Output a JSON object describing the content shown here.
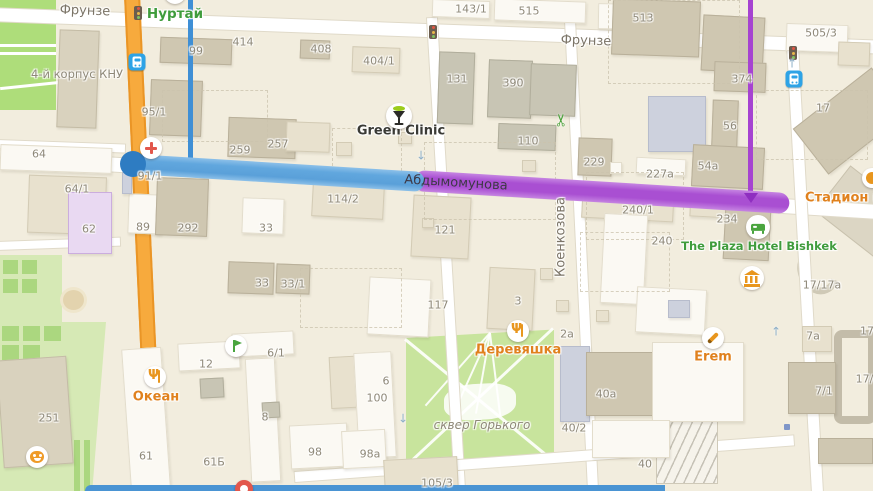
{
  "map_title": "Bishkek map — route highlighted on Abdymomunova street",
  "colors": {
    "background": "#f2edde",
    "major_road_orange": "#f7aa3d",
    "route_blue": "#61a7de",
    "route_blue_dark": "#2e7cc2",
    "route_purple": "#a94fd2",
    "poi_orange": "#e0811d",
    "poi_green": "#3f9c3c",
    "label_gray": "#8e8878",
    "park_green": "#c8e49d"
  },
  "route": {
    "street": "Абдымомунова",
    "segments": [
      {
        "color": "blue",
        "from_x": 133,
        "to_x": 424
      },
      {
        "color": "purple",
        "from_x": 414,
        "to_x": 790
      }
    ],
    "has_start_marker": true,
    "has_direction_arrow": true
  },
  "street_labels": [
    {
      "label": "Фрунзе",
      "x": 85,
      "y": 11,
      "rot": 2,
      "cls": "street"
    },
    {
      "label": "Фрунзе",
      "x": 586,
      "y": 41,
      "rot": 2,
      "cls": "street"
    },
    {
      "label": "Абдымомунова",
      "x": 456,
      "y": 183,
      "rot": 3.5,
      "cls": "onroute"
    },
    {
      "label": "Коенкозова",
      "x": 561,
      "y": 237,
      "rot": -90,
      "cls": "street"
    }
  ],
  "area_labels": [
    {
      "label": "4-й корпус КНУ",
      "x": 77,
      "y": 74,
      "size": 11.5,
      "italic": false
    },
    {
      "label": "сквер Горького",
      "x": 482,
      "y": 425,
      "size": 12,
      "italic": true
    }
  ],
  "poi_labels": [
    {
      "label": "Нуртай",
      "cls": "poi-green",
      "x": 175,
      "y": 14,
      "size": 13.5
    },
    {
      "label": "Green Clinic",
      "cls": "poi-dark",
      "x": 401,
      "y": 131,
      "size": 13
    },
    {
      "label": "Океан",
      "cls": "poi-orange",
      "x": 156,
      "y": 397,
      "size": 13
    },
    {
      "label": "Деревяшка",
      "cls": "poi-orange",
      "x": 518,
      "y": 350,
      "size": 13
    },
    {
      "label": "Erem",
      "cls": "poi-orange",
      "x": 713,
      "y": 357,
      "size": 13
    },
    {
      "label": "The Plaza Hotel Bishkek",
      "cls": "poi-green",
      "x": 759,
      "y": 246,
      "size": 11.5
    },
    {
      "label": "Стадион им. До",
      "cls": "poi-orange",
      "x": 805,
      "y": 198,
      "size": 13,
      "anchor": "left"
    }
  ],
  "building_numbers": [
    {
      "t": "99",
      "x": 196,
      "y": 51
    },
    {
      "t": "414",
      "x": 243,
      "y": 42
    },
    {
      "t": "408",
      "x": 321,
      "y": 49
    },
    {
      "t": "404/1",
      "x": 379,
      "y": 61
    },
    {
      "t": "143/1",
      "x": 471,
      "y": 9
    },
    {
      "t": "515",
      "x": 529,
      "y": 11
    },
    {
      "t": "513",
      "x": 643,
      "y": 18
    },
    {
      "t": "505/3",
      "x": 821,
      "y": 33
    },
    {
      "t": "374",
      "x": 742,
      "y": 79
    },
    {
      "t": "17",
      "x": 823,
      "y": 108
    },
    {
      "t": "56",
      "x": 730,
      "y": 126
    },
    {
      "t": "131",
      "x": 457,
      "y": 79
    },
    {
      "t": "390",
      "x": 513,
      "y": 83
    },
    {
      "t": "110",
      "x": 528,
      "y": 141
    },
    {
      "t": "95/1",
      "x": 154,
      "y": 112
    },
    {
      "t": "257",
      "x": 278,
      "y": 144
    },
    {
      "t": "259",
      "x": 240,
      "y": 150
    },
    {
      "t": "229",
      "x": 594,
      "y": 162
    },
    {
      "t": "227a",
      "x": 660,
      "y": 174
    },
    {
      "t": "54a",
      "x": 708,
      "y": 166
    },
    {
      "t": "64",
      "x": 39,
      "y": 154
    },
    {
      "t": "64/1",
      "x": 77,
      "y": 189
    },
    {
      "t": "62",
      "x": 89,
      "y": 229
    },
    {
      "t": "89",
      "x": 143,
      "y": 227
    },
    {
      "t": "292",
      "x": 188,
      "y": 228
    },
    {
      "t": "33",
      "x": 266,
      "y": 228
    },
    {
      "t": "33",
      "x": 262,
      "y": 283
    },
    {
      "t": "33/1",
      "x": 293,
      "y": 284
    },
    {
      "t": "91/1",
      "x": 150,
      "y": 176
    },
    {
      "t": "114/2",
      "x": 343,
      "y": 199
    },
    {
      "t": "121",
      "x": 445,
      "y": 230
    },
    {
      "t": "117",
      "x": 438,
      "y": 305
    },
    {
      "t": "3",
      "x": 518,
      "y": 301
    },
    {
      "t": "2a",
      "x": 567,
      "y": 334
    },
    {
      "t": "240/1",
      "x": 638,
      "y": 210
    },
    {
      "t": "240",
      "x": 662,
      "y": 241
    },
    {
      "t": "234",
      "x": 727,
      "y": 219
    },
    {
      "t": "17/17a",
      "x": 822,
      "y": 285
    },
    {
      "t": "251",
      "x": 49,
      "y": 418
    },
    {
      "t": "12",
      "x": 206,
      "y": 364
    },
    {
      "t": "6/1",
      "x": 276,
      "y": 353
    },
    {
      "t": "8",
      "x": 265,
      "y": 417
    },
    {
      "t": "61",
      "x": 146,
      "y": 456
    },
    {
      "t": "61Б",
      "x": 214,
      "y": 462
    },
    {
      "t": "6",
      "x": 386,
      "y": 381
    },
    {
      "t": "100",
      "x": 377,
      "y": 398
    },
    {
      "t": "98",
      "x": 315,
      "y": 452
    },
    {
      "t": "98a",
      "x": 370,
      "y": 454
    },
    {
      "t": "105/3",
      "x": 437,
      "y": 483
    },
    {
      "t": "40/2",
      "x": 574,
      "y": 428
    },
    {
      "t": "40a",
      "x": 606,
      "y": 394
    },
    {
      "t": "40",
      "x": 645,
      "y": 464
    },
    {
      "t": "7a",
      "x": 813,
      "y": 336
    },
    {
      "t": "7/1",
      "x": 824,
      "y": 391
    },
    {
      "t": "17",
      "x": 867,
      "y": 331
    },
    {
      "t": "17/1",
      "x": 868,
      "y": 379
    }
  ],
  "icons": [
    {
      "name": "traffic-light-icon",
      "type": "traffic",
      "x": 138,
      "y": 13,
      "interactable": false
    },
    {
      "name": "traffic-light-icon",
      "type": "traffic",
      "x": 433,
      "y": 32,
      "interactable": false
    },
    {
      "name": "traffic-light-icon",
      "type": "traffic",
      "x": 793,
      "y": 53,
      "interactable": false
    },
    {
      "name": "bus-stop-icon",
      "type": "bus",
      "x": 137,
      "y": 62,
      "interactable": true
    },
    {
      "name": "bus-stop-icon",
      "type": "bus",
      "x": 794,
      "y": 79,
      "interactable": true
    },
    {
      "name": "hospital-cross-icon",
      "type": "cross",
      "x": 151,
      "y": 148,
      "interactable": true
    },
    {
      "name": "green-clinic-icon",
      "type": "clinic",
      "x": 399,
      "y": 116,
      "interactable": true
    },
    {
      "name": "scissors-icon",
      "type": "scissors",
      "x": 562,
      "y": 120,
      "interactable": true
    },
    {
      "name": "hotel-bed-icon",
      "type": "bed",
      "x": 758,
      "y": 227,
      "interactable": true
    },
    {
      "name": "museum-icon",
      "type": "museum",
      "x": 752,
      "y": 278,
      "interactable": true
    },
    {
      "name": "restaurant-icon",
      "type": "food",
      "x": 155,
      "y": 377,
      "interactable": true
    },
    {
      "name": "restaurant-icon",
      "type": "food",
      "x": 518,
      "y": 331,
      "interactable": true
    },
    {
      "name": "pencil-icon",
      "type": "pencil",
      "x": 713,
      "y": 338,
      "interactable": true
    },
    {
      "name": "flag-icon",
      "type": "flag",
      "x": 236,
      "y": 346,
      "interactable": true
    },
    {
      "name": "theater-masks-icon",
      "type": "theater",
      "x": 37,
      "y": 457,
      "interactable": true
    },
    {
      "name": "partial-poi-icon",
      "type": "cut-green",
      "x": 175,
      "y": -7,
      "interactable": true
    },
    {
      "name": "partial-poi-icon",
      "type": "cut-orange",
      "x": 872,
      "y": 178,
      "interactable": true
    },
    {
      "name": "partial-poi-icon",
      "type": "cut-red",
      "x": 244,
      "y": 489,
      "interactable": true
    },
    {
      "name": "entrance-dot-icon",
      "type": "dot",
      "x": 787,
      "y": 427,
      "interactable": false
    },
    {
      "name": "oneway-arrow-icon",
      "type": "arrow-down",
      "x": 421,
      "y": 154,
      "interactable": false
    },
    {
      "name": "oneway-arrow-icon",
      "type": "arrow-down",
      "x": 403,
      "y": 417,
      "interactable": false
    },
    {
      "name": "oneway-arrow-icon",
      "type": "arrow-up",
      "x": 776,
      "y": 330,
      "interactable": false
    },
    {
      "name": "oneway-arrow-icon",
      "type": "arrow-up",
      "x": 792,
      "y": 62,
      "interactable": false
    }
  ]
}
